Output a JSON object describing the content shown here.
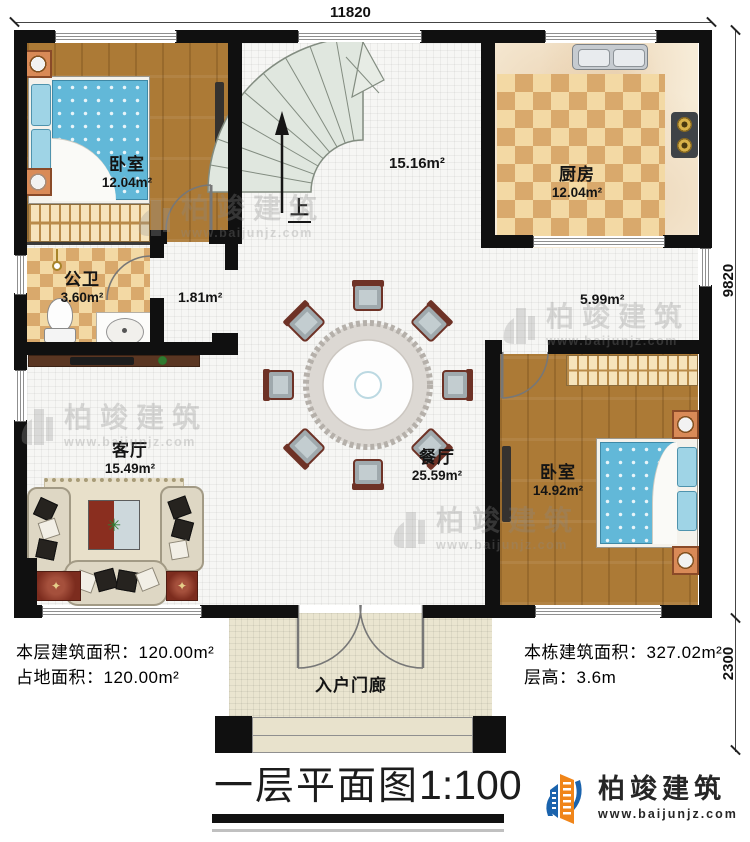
{
  "dimensions": {
    "top": "11820",
    "right_upper": "9820",
    "right_lower": "2300"
  },
  "rooms": {
    "bedroom1": {
      "name": "卧室",
      "area": "12.04m²"
    },
    "kitchen": {
      "name": "厨房",
      "area": "12.04m²"
    },
    "bathroom": {
      "name": "公卫",
      "area": "3.60m²"
    },
    "living": {
      "name": "客厅",
      "area": "15.49m²"
    },
    "dining": {
      "name": "餐厅",
      "area": "25.59m²"
    },
    "bedroom2": {
      "name": "卧室",
      "area": "14.92m²"
    },
    "porch": {
      "name": "入户门廊"
    },
    "stairwell": {
      "area": "15.16m²",
      "up_label": "上"
    },
    "hallway": {
      "area": "1.81m²"
    },
    "corridor": {
      "area": "5.99m²"
    }
  },
  "info": {
    "left_line1_label": "本层建筑面积：",
    "left_line1_value": "120.00m²",
    "left_line2_label": "占地面积：",
    "left_line2_value": "120.00m²",
    "right_line1_label": "本栋建筑面积：",
    "right_line1_value": "327.02m²",
    "right_line2_label": "层高：",
    "right_line2_value": "3.6m"
  },
  "title": {
    "text": "一层平面图",
    "scale": "1:100"
  },
  "brand": {
    "name": "柏竣建筑",
    "url": "www.baijunjz.com"
  },
  "watermark": {
    "text": "柏竣建筑",
    "url": "www.baijunjz.com"
  },
  "colors": {
    "wall": "#101010",
    "wood": "#ac7a36",
    "checker": "#d9a96c",
    "bed": "#62b8d8",
    "brand_orange": "#f08519",
    "brand_blue": "#1a63ad"
  }
}
